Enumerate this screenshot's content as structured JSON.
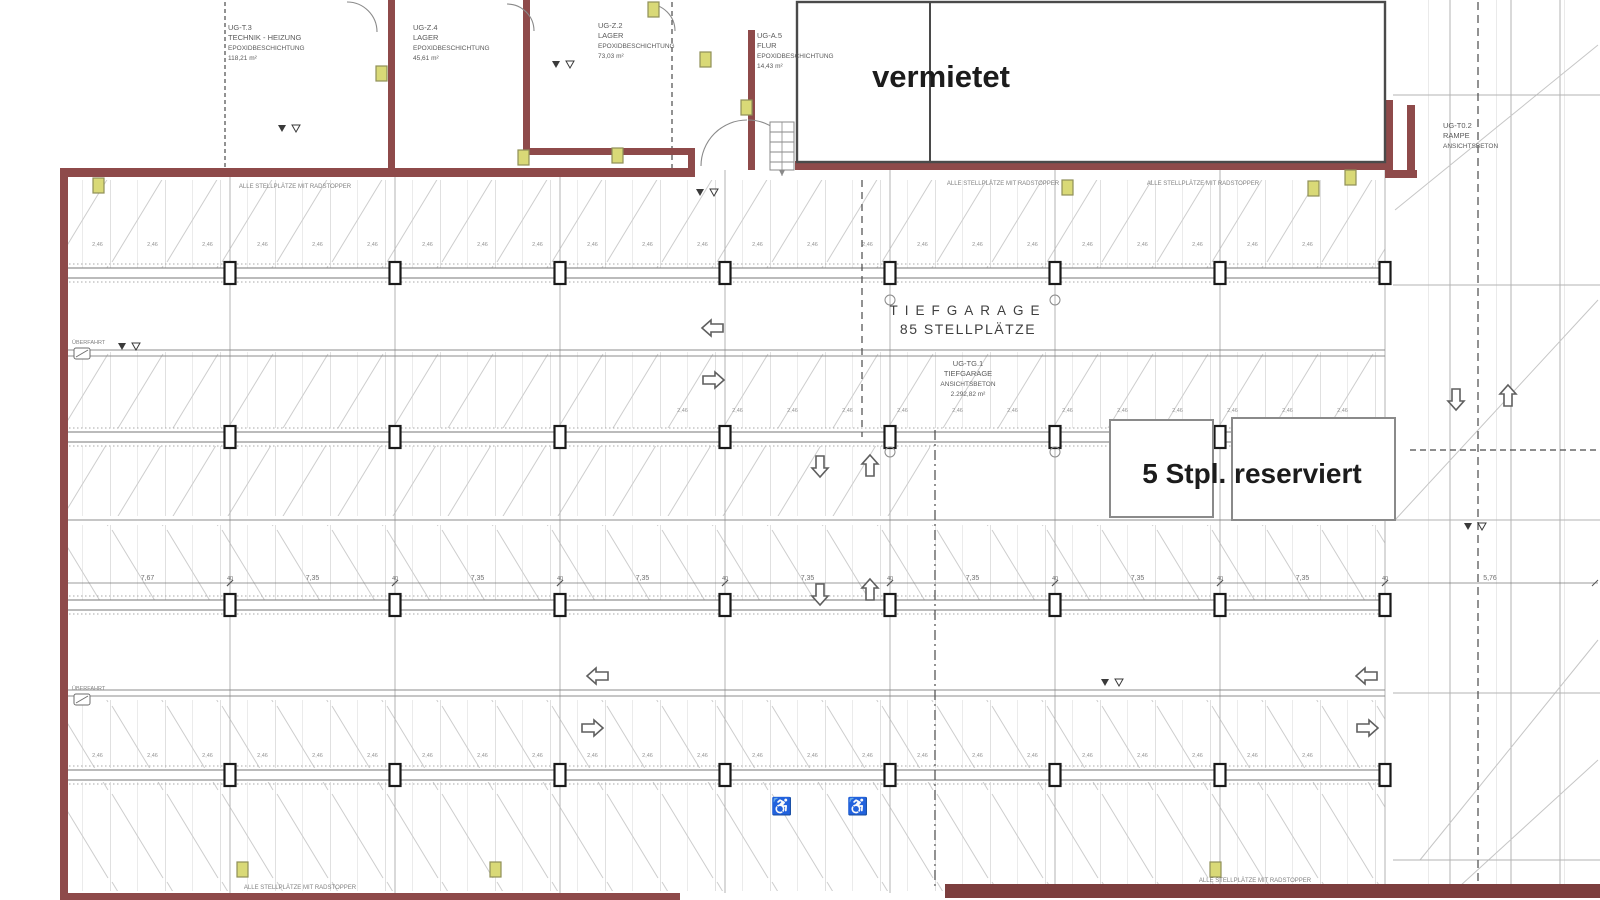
{
  "doc": {
    "overlay_vermietet": "vermietet",
    "overlay_reserved": "5 Stpl. reserviert",
    "garage_title_line1": "TIEFGARAGE",
    "garage_title_line2": "85 STELLPLÄTZE",
    "note_radstopper": "ALLE STELLPLÄTZE MIT RADSTOPPER",
    "left_note": "ÜBERFAHRT"
  },
  "rooms": [
    {
      "id": "ug-t3",
      "x": 228,
      "y": 30,
      "anchor": "start",
      "lines": [
        "UG-T.3",
        "TECHNIK - HEIZUNG",
        "EPOXIDBESCHICHTUNG",
        "118,21 m²"
      ]
    },
    {
      "id": "ug-z4",
      "x": 413,
      "y": 30,
      "anchor": "start",
      "lines": [
        "UG-Z.4",
        "LAGER",
        "EPOXIDBESCHICHTUNG",
        "45,61 m²"
      ]
    },
    {
      "id": "ug-z2",
      "x": 598,
      "y": 28,
      "anchor": "start",
      "lines": [
        "UG-Z.2",
        "LAGER",
        "EPOXIDBESCHICHTUNG",
        "73,03 m²"
      ]
    },
    {
      "id": "ug-a5",
      "x": 757,
      "y": 38,
      "anchor": "start",
      "lines": [
        "UG-A.5",
        "FLUR",
        "EPOXIDBESCHICHTUNG",
        "14,43 m²"
      ]
    },
    {
      "id": "ug-tg1",
      "x": 968,
      "y": 366,
      "anchor": "middle",
      "lines": [
        "UG-TG.1",
        "TIEFGARAGE",
        "ANSICHTSBETON",
        "2.292,82 m²"
      ]
    },
    {
      "id": "ug-t02",
      "x": 1443,
      "y": 128,
      "anchor": "start",
      "lines": [
        "UG-T0.2",
        "RAMPE",
        "ANSICHTSBETON"
      ]
    }
  ],
  "notes": [
    {
      "x": 295,
      "y": 188
    },
    {
      "x": 1003,
      "y": 185
    },
    {
      "x": 1203,
      "y": 185
    },
    {
      "x": 300,
      "y": 889
    },
    {
      "x": 1255,
      "y": 882
    }
  ],
  "plan": {
    "colors": {
      "wall": "#8e4a4a",
      "wall_dark": "#7c3e3e",
      "grid": "#b3b3b3",
      "beam": "#777777",
      "dotted": "#a8a8a8",
      "dash": "#4a4a4a",
      "diag": "#c6c6c6",
      "box_stroke": "#4a4a4a",
      "res_stroke": "#8a8a8a",
      "vent_fill": "#d9d977",
      "vent_stroke": "#8f8f58",
      "column_stroke": "#1a1a1a",
      "symbol": "#5f5f5f"
    },
    "grid": {
      "xs": [
        230,
        395,
        560,
        725,
        890,
        1055,
        1220,
        1385
      ],
      "beam_ys": [
        273,
        437,
        605,
        775
      ],
      "x_top": 170,
      "x_bottom": 893,
      "ramp_xs": [
        1450,
        1511,
        1560
      ]
    },
    "hlines": [
      350,
      356,
      520,
      690,
      696
    ],
    "ramp_hlines": [
      95,
      285,
      520,
      693,
      860
    ],
    "dashed": [
      {
        "x1": 862,
        "y1": 180,
        "x2": 862,
        "y2": 437,
        "dash": "7,5"
      },
      {
        "x1": 935,
        "y1": 430,
        "x2": 935,
        "y2": 886,
        "dash": "10,4,2,4"
      },
      {
        "x1": 1478,
        "y1": 2,
        "x2": 1478,
        "y2": 886,
        "dash": "8,5"
      },
      {
        "x1": 672,
        "y1": 2,
        "x2": 672,
        "y2": 168,
        "dash": "5,4"
      },
      {
        "x1": 225,
        "y1": 2,
        "x2": 225,
        "y2": 168,
        "dash": "4,3"
      },
      {
        "x1": 1410,
        "y1": 450,
        "x2": 1598,
        "y2": 450,
        "dash": "6,4"
      }
    ],
    "diagonals": [
      [
        1395,
        210,
        1598,
        45
      ],
      [
        1395,
        520,
        1598,
        300
      ],
      [
        1420,
        860,
        1598,
        640
      ],
      [
        1460,
        886,
        1598,
        760
      ]
    ],
    "dims": {
      "chain_y": 583,
      "col_label": "40",
      "stall_label": "2,46",
      "chain": [
        {
          "x1": 65,
          "x2": 230,
          "v": "7,67"
        },
        {
          "x1": 230,
          "x2": 395,
          "v": "7,35"
        },
        {
          "x1": 395,
          "x2": 560,
          "v": "7,35"
        },
        {
          "x1": 560,
          "x2": 725,
          "v": "7,35"
        },
        {
          "x1": 725,
          "x2": 890,
          "v": "7,35"
        },
        {
          "x1": 890,
          "x2": 1055,
          "v": "7,35"
        },
        {
          "x1": 1055,
          "x2": 1220,
          "v": "7,35"
        },
        {
          "x1": 1220,
          "x2": 1385,
          "v": "7,35"
        },
        {
          "x1": 1385,
          "x2": 1595,
          "v": "5,76"
        }
      ],
      "stall_rows": [
        {
          "y": 246,
          "x1": 70,
          "x2": 1385
        },
        {
          "y": 412,
          "x1": 655,
          "x2": 1380
        },
        {
          "y": 757,
          "x1": 70,
          "x2": 1385
        }
      ]
    },
    "arrows": [
      {
        "x": 713,
        "y": 328,
        "dir": "left"
      },
      {
        "x": 713,
        "y": 380,
        "dir": "right"
      },
      {
        "x": 820,
        "y": 466,
        "dir": "down"
      },
      {
        "x": 870,
        "y": 466,
        "dir": "up"
      },
      {
        "x": 820,
        "y": 594,
        "dir": "down"
      },
      {
        "x": 870,
        "y": 590,
        "dir": "up"
      },
      {
        "x": 598,
        "y": 676,
        "dir": "left"
      },
      {
        "x": 592,
        "y": 728,
        "dir": "right"
      },
      {
        "x": 1367,
        "y": 676,
        "dir": "left"
      },
      {
        "x": 1367,
        "y": 728,
        "dir": "right"
      },
      {
        "x": 1456,
        "y": 399,
        "dir": "down"
      },
      {
        "x": 1508,
        "y": 396,
        "dir": "up"
      }
    ],
    "wheelchairs": [
      {
        "x": 782,
        "y": 812
      },
      {
        "x": 858,
        "y": 812
      }
    ],
    "vents": [
      [
        93,
        178
      ],
      [
        376,
        66
      ],
      [
        518,
        150
      ],
      [
        612,
        148
      ],
      [
        648,
        2
      ],
      [
        700,
        52
      ],
      [
        741,
        100
      ],
      [
        1062,
        180
      ],
      [
        1308,
        181
      ],
      [
        1345,
        170
      ],
      [
        237,
        862
      ],
      [
        490,
        862
      ],
      [
        1210,
        862
      ]
    ],
    "markers": [
      [
        282,
        132
      ],
      [
        556,
        68
      ],
      [
        122,
        350
      ],
      [
        1105,
        686
      ],
      [
        1468,
        530
      ],
      [
        700,
        196
      ]
    ],
    "bubbles": [
      [
        890,
        300
      ],
      [
        1055,
        300
      ],
      [
        890,
        452
      ],
      [
        1055,
        452
      ]
    ],
    "left_notes": [
      {
        "x": 72,
        "y": 344
      },
      {
        "x": 72,
        "y": 690
      }
    ]
  }
}
